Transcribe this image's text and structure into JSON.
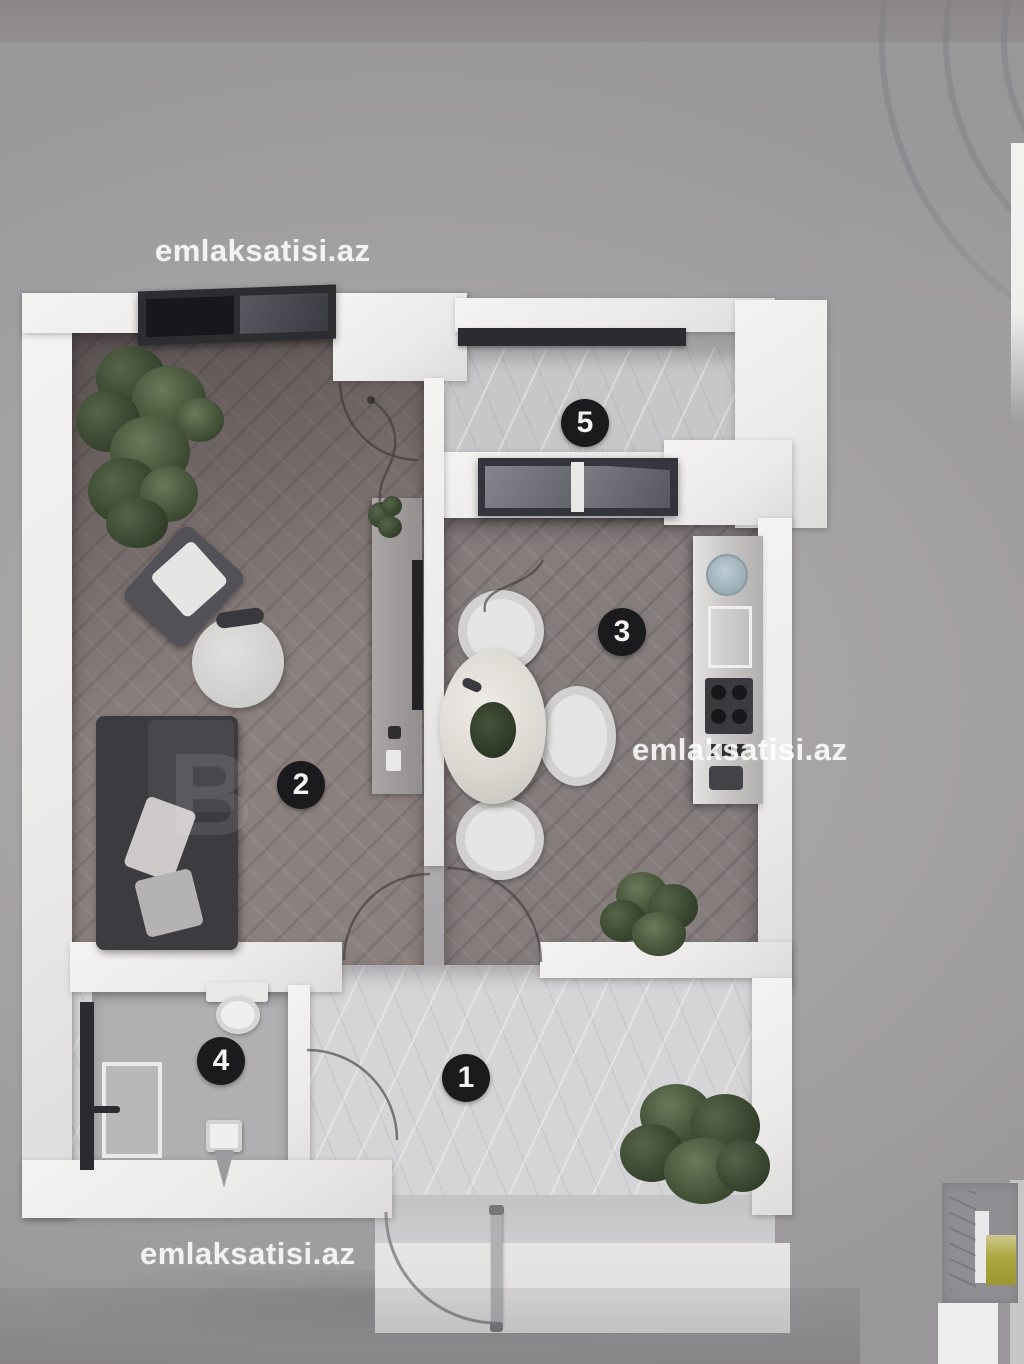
{
  "page": {
    "description": "3D top-down floor plan render of a one-bedroom apartment, real-estate listing photo",
    "background_color": "#a5a2a5",
    "topbar_color": "#8d898c"
  },
  "watermark": {
    "text": "emlaksatisi.az",
    "color": "rgba(255,255,255,0.85)"
  },
  "partial_watermark": {
    "text": "B"
  },
  "rooms": [
    {
      "number": "1"
    },
    {
      "number": "2"
    },
    {
      "number": "3"
    },
    {
      "number": "4"
    },
    {
      "number": "5"
    }
  ],
  "colors": {
    "wall_white": "#f1f0ee",
    "wood_floor": "#8b807e",
    "kitchen_floor": "#857c7c",
    "hall_marble": "#d5d4d6",
    "bathroom_floor": "#b1afb1",
    "balcony_floor": "#c7c6c9",
    "badge_bg": "#1b1b1e",
    "badge_fg": "#f4f2ee",
    "sofa": "#3b3b40",
    "plant_green": "#39462f",
    "thumbnail_yellow": "#aba63f"
  }
}
